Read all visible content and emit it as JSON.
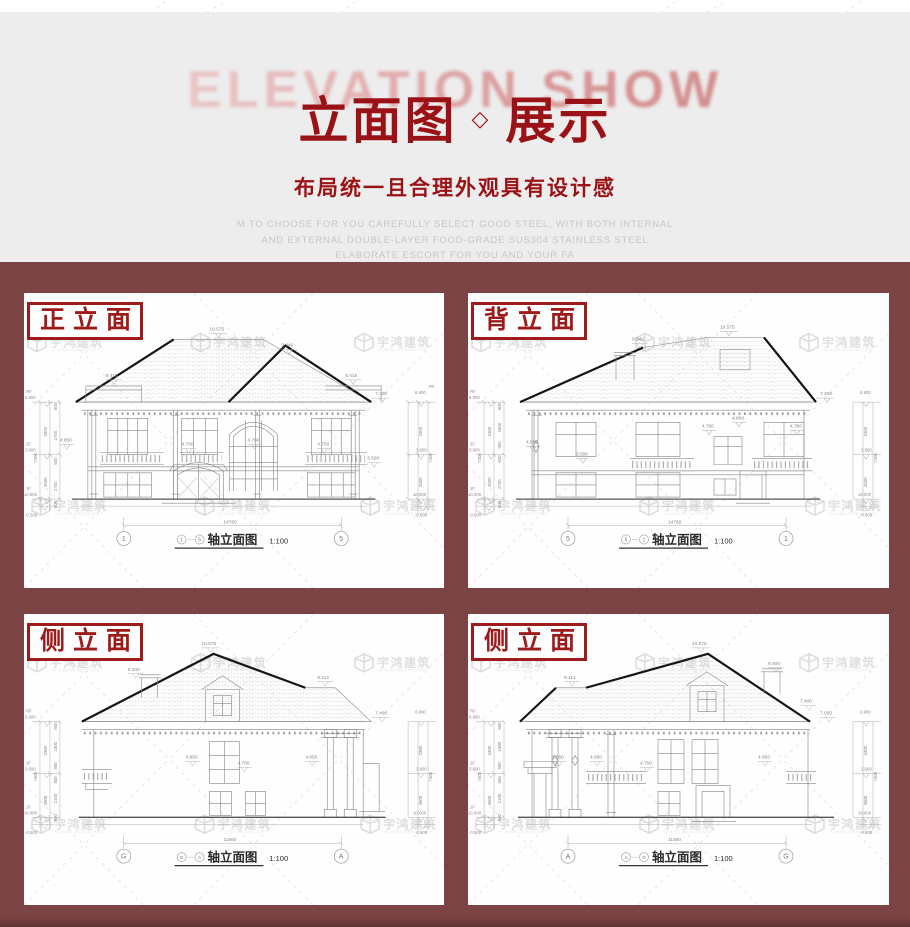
{
  "colors": {
    "header_bg": "#ededed",
    "section_bg": "#7b4343",
    "accent_red": "#9e1b1b",
    "title_red": "#9b1216",
    "muted_gray": "#c6c6c6",
    "backdrop_pink_from": "#f3dcdc",
    "backdrop_pink_to": "#cd8181",
    "watermark_gray": "#c4c4c4"
  },
  "header": {
    "backdrop_text": "ELEVATION SHOW",
    "title_part1": "立面图",
    "title_separator": "◇",
    "title_part2": "展示",
    "subtitle": "布局统一且合理外观具有设计感",
    "desc_line1": "M TO CHOOSE FOR YOU CAREFULLY SELECT GOOD STEEL, WITH BOTH INTERNAL",
    "desc_line2": "AND EXTERNAL DOUBLE-LAYER FOOD-GRADE SUS304 STAINLESS STEEL",
    "desc_line3": "ELABORATE ESCORT FOR YOU AND YOUR FA"
  },
  "watermark": {
    "name_cn": "宇鸿建筑",
    "name_en": "YU HONG ARCHITECTURE"
  },
  "captions": {
    "axis_word": "轴立面图",
    "scale": "1:100"
  },
  "panels": [
    {
      "label": "正立面",
      "axis_left": "1",
      "axis_right": "5",
      "dims": {
        "ridge": "10.575",
        "ridge2": "9.940",
        "flag_l": "9.415",
        "flag_r": "9.415",
        "eave_r": "7.400",
        "rf_tag": "RF",
        "rf": "6.900",
        "f2_tag": "2F",
        "f2": "3.600",
        "f1_tag": "1F",
        "f1": "±0.000",
        "below": "-0.500",
        "span": "14760",
        "total": "7400",
        "mids": [
          "4.850",
          "4.700",
          "4.700",
          "4.700",
          "3.500"
        ],
        "stack": [
          "600",
          "2700",
          "600",
          "2700",
          "500"
        ],
        "stack2": [
          "3300",
          "3600"
        ]
      }
    },
    {
      "label": "背立面",
      "axis_left": "5",
      "axis_right": "1",
      "dims": {
        "ridge": "10.575",
        "ridge2": "9.940",
        "eave_r": "7.400",
        "rf_tag": "RF",
        "rf": "6.900",
        "f2_tag": "2F",
        "f2": "3.600",
        "f1_tag": "1F",
        "f1": "±0.000",
        "below": "-0.500",
        "span": "14760",
        "total": "7400",
        "mids": [
          "4.850",
          "3.500",
          "4.700",
          "4.800",
          "4.700"
        ],
        "stack": [
          "600",
          "1800",
          "900",
          "600",
          "2700",
          "500"
        ],
        "stack2": [
          "3300",
          "3600"
        ]
      }
    },
    {
      "label": "侧立面",
      "axis_left": "G",
      "axis_right": "A",
      "dims": {
        "ridge": "10.575",
        "chimney": "9.400",
        "ridge2": "9.114",
        "eave_r": "7.400",
        "rf_tag": "RF",
        "rf": "6.900",
        "f2_tag": "2F",
        "f2": "3.600",
        "f1_tag": "1F",
        "f1": "±0.000",
        "below": "-0.500",
        "span": "11560",
        "total": "7400",
        "mids": [
          "4.850",
          "4.700",
          "4.850"
        ],
        "stack": [
          "600",
          "1800",
          "900",
          "600",
          "2100",
          "900"
        ],
        "stack2": [
          "3300",
          "3600"
        ]
      }
    },
    {
      "label": "侧立面",
      "axis_left": "A",
      "axis_right": "G",
      "dims": {
        "ridge": "10.575",
        "ridge2": "9.114",
        "chimney": "9.400",
        "eave_r": "7.400",
        "eave_r2": "7.050",
        "rf_tag": "RF",
        "rf": "6.900",
        "f2_tag": "2F",
        "f2": "3.600",
        "f1_tag": "1F",
        "f1": "±0.000",
        "below": "-0.500",
        "span": "11560",
        "total": "7400",
        "mids": [
          "4.850",
          "4.850",
          "4.700",
          "4.850"
        ],
        "stack": [
          "600",
          "1800",
          "900",
          "600",
          "2100",
          "900"
        ],
        "stack2": [
          "3300",
          "3600"
        ]
      }
    }
  ]
}
